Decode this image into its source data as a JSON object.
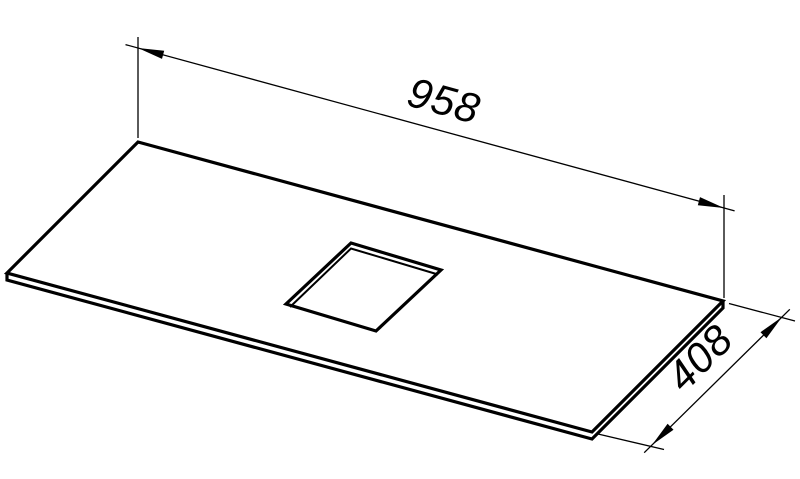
{
  "drawing": {
    "colors": {
      "line": "#000000",
      "background": "#ffffff"
    },
    "dimension_labels": {
      "length": "958",
      "depth": "408"
    }
  }
}
